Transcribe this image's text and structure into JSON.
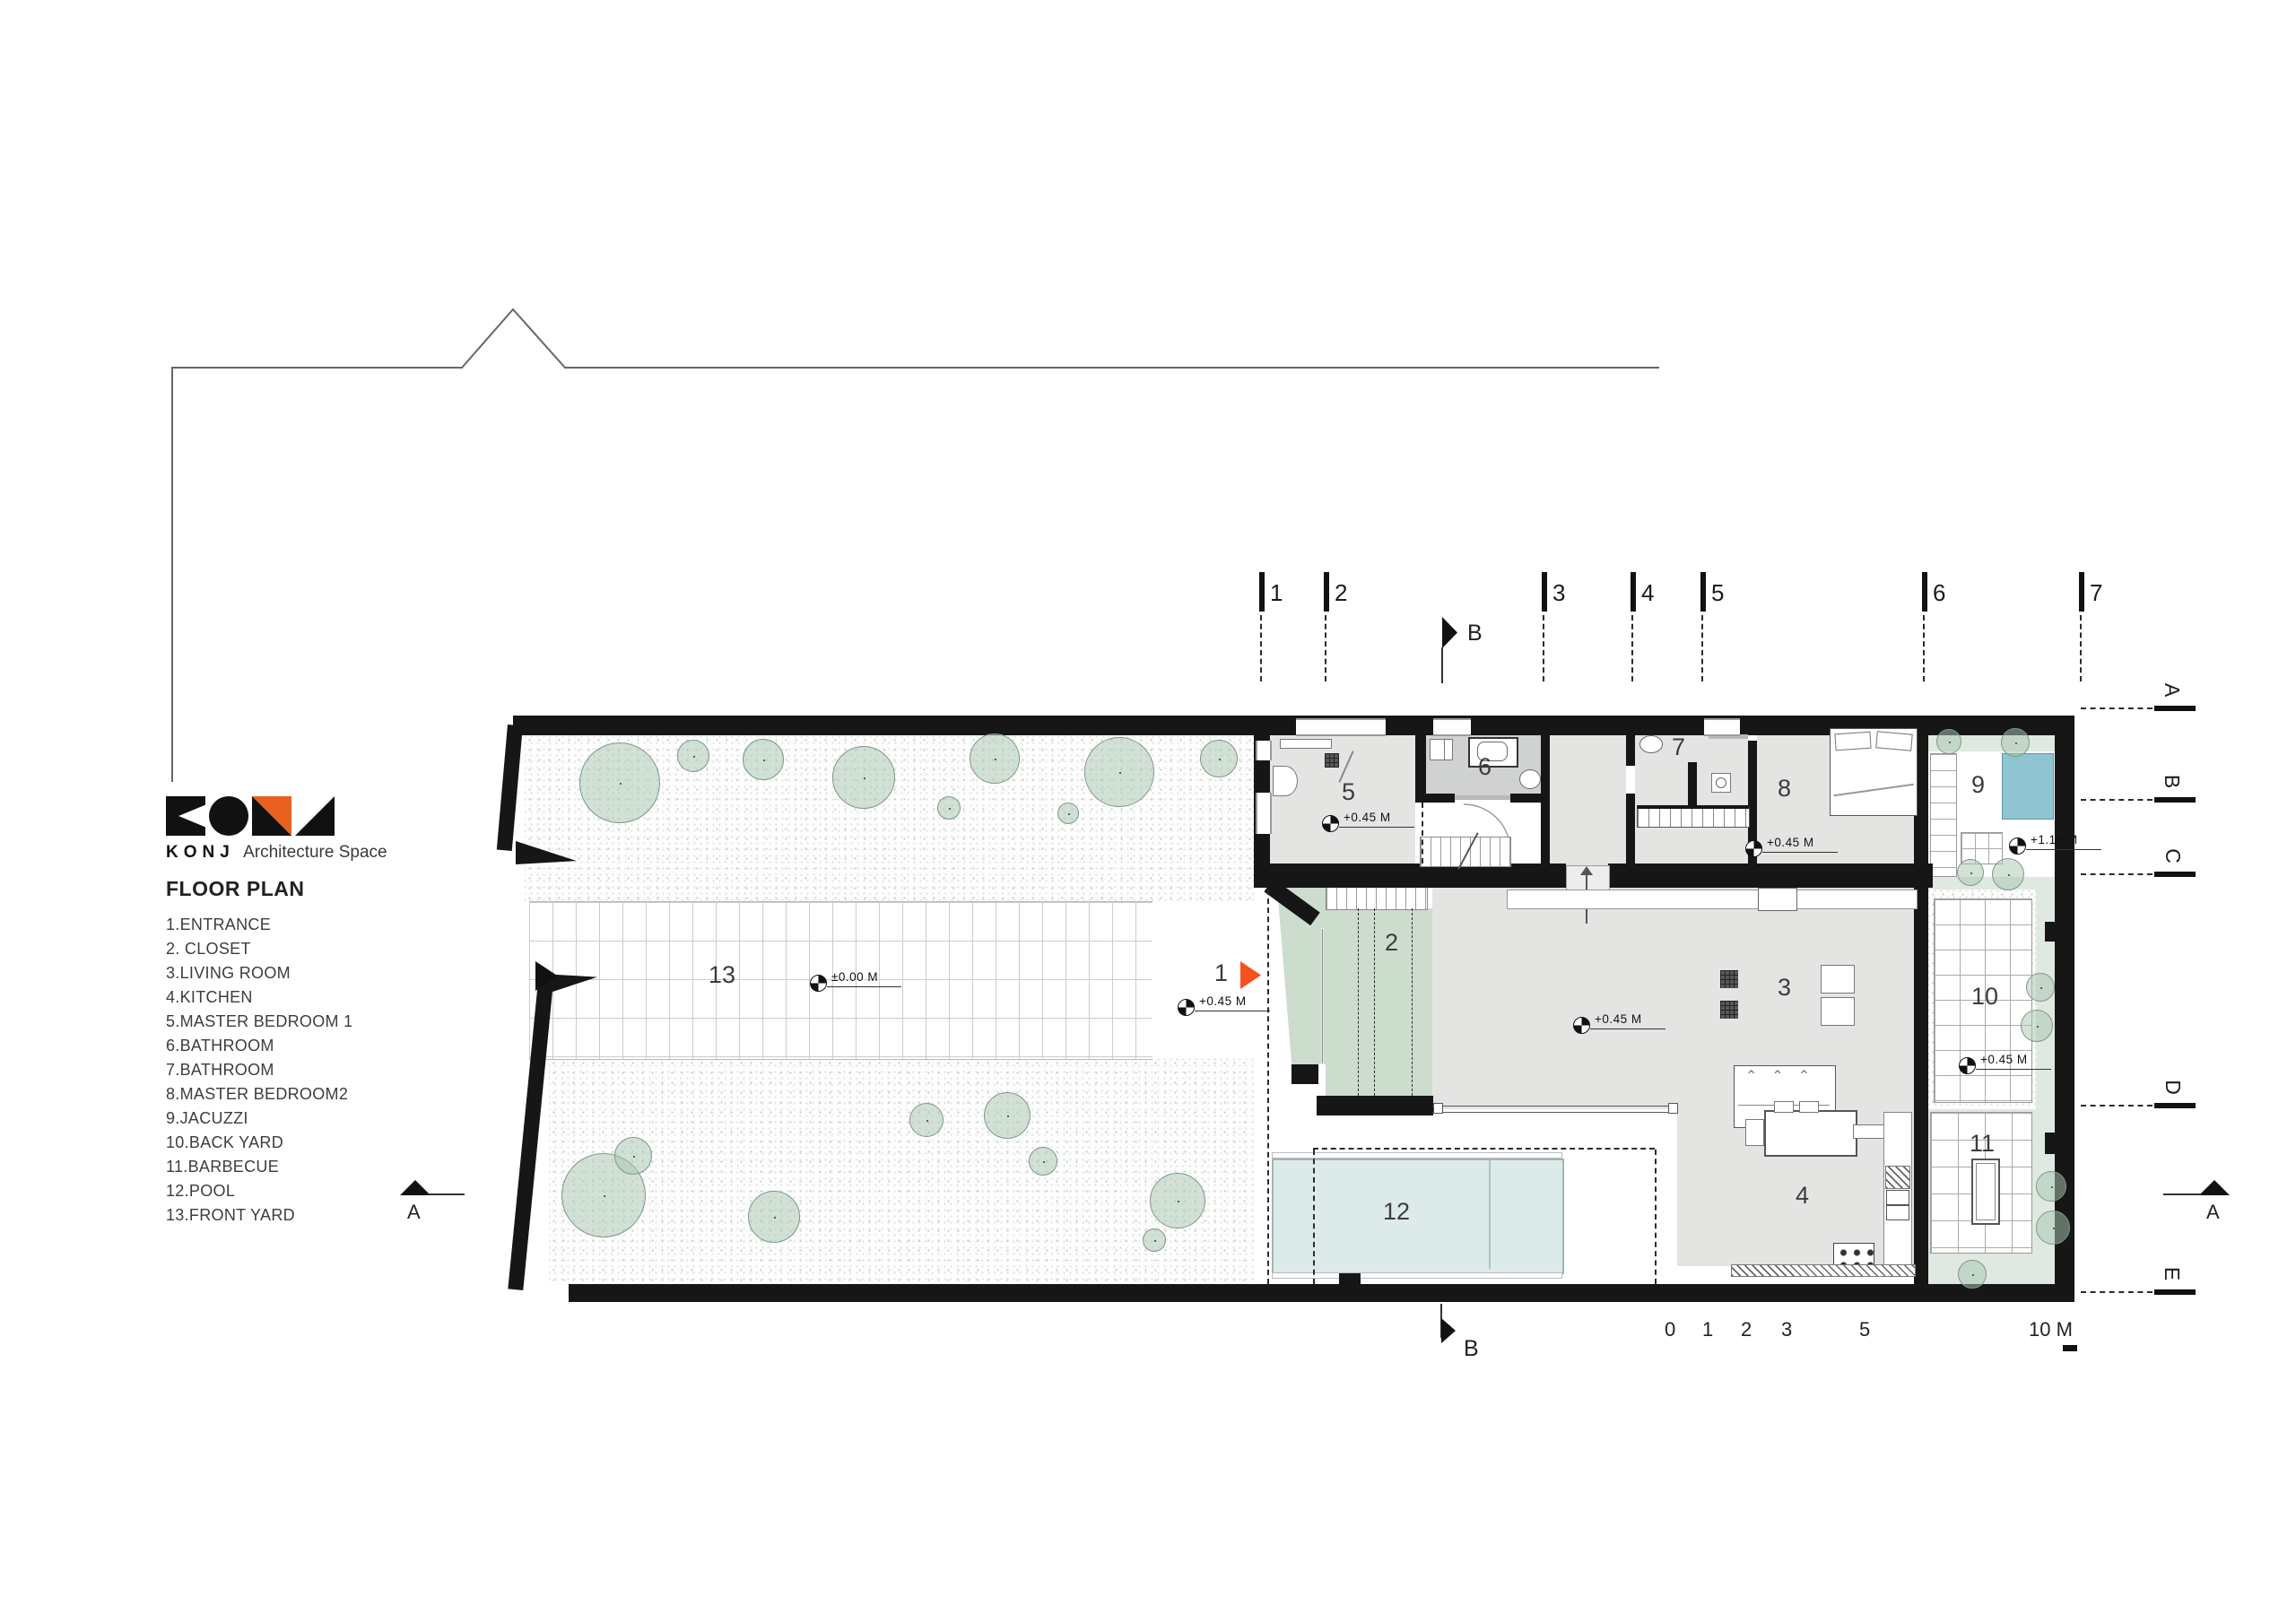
{
  "logo": {
    "brand": "KONJ",
    "tagline": "Architecture Space"
  },
  "legend": {
    "title": "FLOOR PLAN",
    "items": [
      "1.ENTRANCE",
      "2. CLOSET",
      "3.LIVING ROOM",
      "4.KITCHEN",
      "5.MASTER BEDROOM 1",
      "6.BATHROOM",
      "7.BATHROOM",
      "8.MASTER BEDROOM2",
      "9.JACUZZI",
      "10.BACK YARD",
      "11.BARBECUE",
      "12.POOL",
      "13.FRONT YARD"
    ]
  },
  "grid_columns": [
    "1",
    "2",
    "3",
    "4",
    "5",
    "6",
    "7"
  ],
  "grid_rows": [
    "A",
    "B",
    "C",
    "D",
    "E"
  ],
  "section_markers": {
    "a_left": "A",
    "a_right": "A",
    "b_top": "B",
    "b_bottom": "B"
  },
  "room_numbers": {
    "entrance": "1",
    "closet": "2",
    "living_room": "3",
    "kitchen": "4",
    "master_bedroom_1": "5",
    "bathroom_1": "6",
    "bathroom_2": "7",
    "master_bedroom_2": "8",
    "jacuzzi": "9",
    "back_yard": "10",
    "barbecue": "11",
    "pool": "12",
    "front_yard": "13"
  },
  "level_markers": {
    "front_yard": "±0.00 M",
    "entrance": "+0.45 M",
    "master_bedroom_1": "+0.45 M",
    "master_bedroom_2": "+0.45 M",
    "living_room": "+0.45 M",
    "jacuzzi": "+1.15 M",
    "back_yard": "+0.45 M"
  },
  "scale_bar": {
    "labels": [
      "0",
      "1",
      "2",
      "3",
      "5",
      "10 M"
    ]
  },
  "colors": {
    "accent_orange": "#e8611f",
    "entrance_arrow_orange": "#f4511e",
    "wall_black": "#161616",
    "pool_blue": "#dcebe9",
    "jacuzzi_blue": "#8fc5d3",
    "landscape_green": "#ccdccd"
  }
}
